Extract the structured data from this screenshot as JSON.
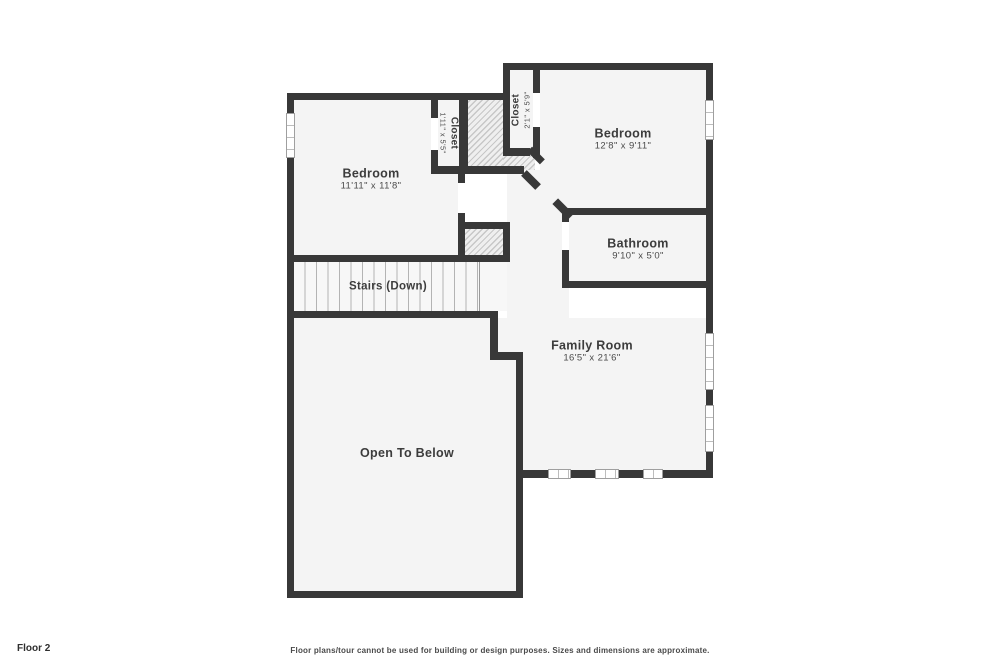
{
  "page": {
    "footer_left": "Floor 2",
    "footer_center": "Floor plans/tour cannot be used for building or design purposes. Sizes and dimensions are approximate."
  },
  "palette": {
    "wall": "#383838",
    "room_fill": "#f4f4f4",
    "hatch_line": "#c7c7c7",
    "window_border": "#9f9f9f",
    "label_text": "#3c3c3c"
  },
  "rooms": [
    {
      "id": "bedroom-left",
      "label": "Bedroom",
      "dims": "11'11\" x 11'8\""
    },
    {
      "id": "closet-left",
      "label": "Closet",
      "dims": "1'11\" x 5'5\""
    },
    {
      "id": "closet-top",
      "label": "Closet",
      "dims": "2'1\" x 5'9\""
    },
    {
      "id": "bedroom-right",
      "label": "Bedroom",
      "dims": "12'8\" x 9'11\""
    },
    {
      "id": "bathroom",
      "label": "Bathroom",
      "dims": "9'10\" x 5'0\""
    },
    {
      "id": "family-room",
      "label": "Family Room",
      "dims": "16'5\" x 21'6\""
    },
    {
      "id": "stairs",
      "label": "Stairs (Down)",
      "dims": ""
    },
    {
      "id": "open-to-below",
      "label": "Open To Below",
      "dims": ""
    }
  ]
}
